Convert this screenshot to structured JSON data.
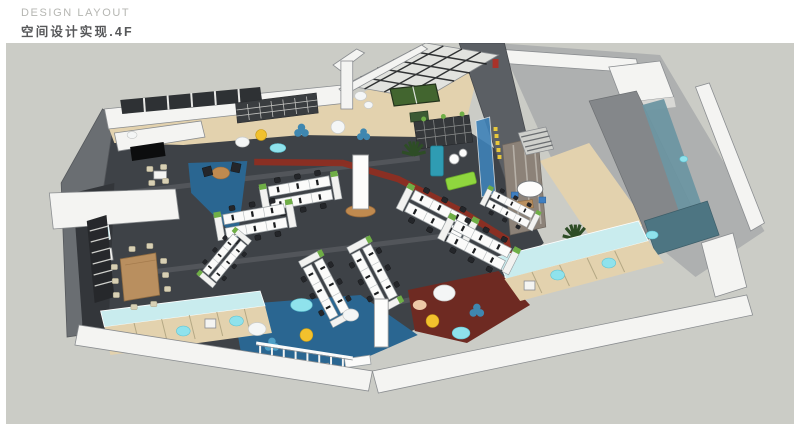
{
  "header": {
    "eyebrow": "DESIGN LAYOUT",
    "title": "空间设计实现.4F"
  },
  "palette": {
    "canvas": "#cbccc6",
    "carpet_dark": "#3e4247",
    "carpet_blue": "#2a6691",
    "carpet_red": "#6e2a22",
    "path_red": "#8e2e22",
    "floor_tan": "#e3d2ae",
    "wall_white": "#f4f4f2",
    "wall_gray": "#9b9ea1",
    "wall_dark": "#5b5f64",
    "glass_cyan": "#c9ecee",
    "glass_teal": "#6d96a2",
    "teal_dark": "#4d7582",
    "sofa_teal": "#2f9cb3",
    "sofa_lime": "#8fd63e",
    "pouf_yellow": "#f2c12d",
    "pouf_cyan": "#8fe2ec",
    "pouf_blue": "#3f87b0",
    "pouf_white": "#f4f6f6",
    "wood": "#b98f5f",
    "pingpong_green": "#42652f",
    "plant_green": "#2e4d26",
    "planter_green": "#6fae46",
    "desk_white": "#fbfbfa",
    "chair_dark": "#24262a",
    "marble": "#8c8278",
    "line_gray": "#8a8d90",
    "eyebrow_color": "#b5b6b2",
    "title_color": "#57585a"
  },
  "scene": {
    "zones": [
      {
        "name": "open-office-desk-area"
      },
      {
        "name": "meeting-rooms-west"
      },
      {
        "name": "beanbag-lounge-blue"
      },
      {
        "name": "beanbag-lounge-red"
      },
      {
        "name": "reading-lounge-north"
      },
      {
        "name": "ping-pong-area"
      },
      {
        "name": "pantry-east"
      },
      {
        "name": "booth-seating-south"
      },
      {
        "name": "booth-seating-southeast"
      }
    ]
  }
}
